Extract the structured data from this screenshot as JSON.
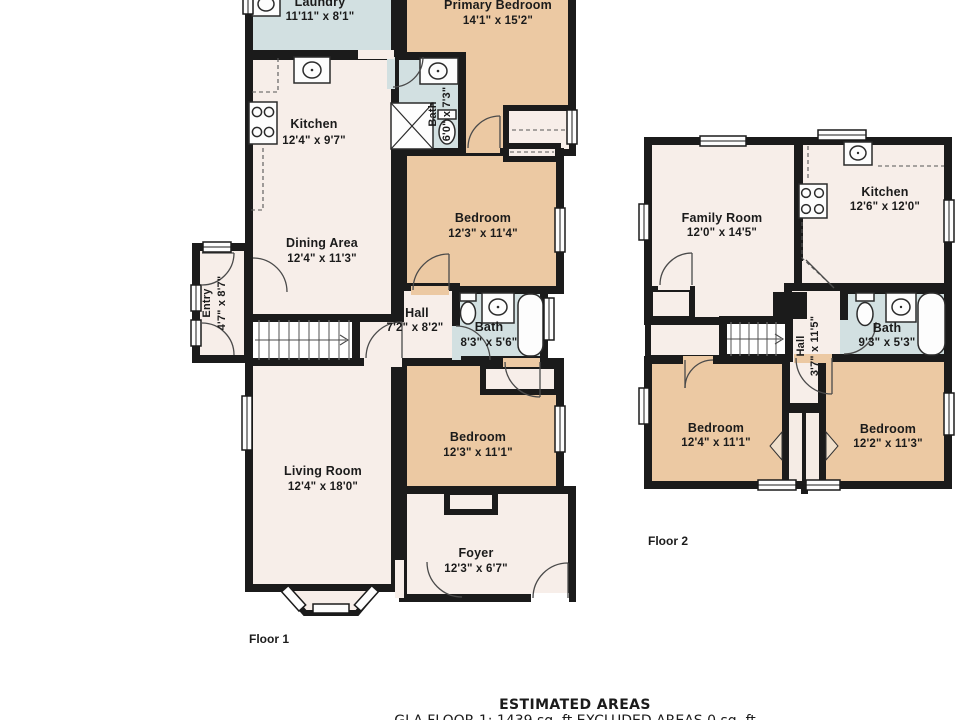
{
  "floor1": {
    "label": "Floor 1",
    "rooms": {
      "laundry": {
        "name": "Laundry",
        "dims": "11'11\" x 8'1\""
      },
      "primary": {
        "name": "Primary Bedroom",
        "dims": "14'1\" x 15'2\""
      },
      "primary_bath": {
        "name": "Bath",
        "dims": "6'0\" x 7'3\""
      },
      "kitchen": {
        "name": "Kitchen",
        "dims": "12'4\" x 9'7\""
      },
      "dining": {
        "name": "Dining Area",
        "dims": "12'4\" x 11'3\""
      },
      "bedroom2": {
        "name": "Bedroom",
        "dims": "12'3\" x 11'4\""
      },
      "hall": {
        "name": "Hall",
        "dims": "7'2\" x 8'2\""
      },
      "bath": {
        "name": "Bath",
        "dims": "8'3\" x 5'6\""
      },
      "entry": {
        "name": "Entry",
        "dims": "4'7\" x 8'7\""
      },
      "living": {
        "name": "Living Room",
        "dims": "12'4\" x 18'0\""
      },
      "bedroom3": {
        "name": "Bedroom",
        "dims": "12'3\" x 11'1\""
      },
      "foyer": {
        "name": "Foyer",
        "dims": "12'3\" x 6'7\""
      }
    }
  },
  "floor2": {
    "label": "Floor 2",
    "rooms": {
      "family": {
        "name": "Family Room",
        "dims": "12'0\" x 14'5\""
      },
      "kitchen": {
        "name": "Kitchen",
        "dims": "12'6\" x 12'0\""
      },
      "bath": {
        "name": "Bath",
        "dims": "9'3\" x 5'3\""
      },
      "hall": {
        "name": "Hall",
        "dims": "3'7\" x 11'5\""
      },
      "bedroom_left": {
        "name": "Bedroom",
        "dims": "12'4\" x 11'1\""
      },
      "bedroom_right": {
        "name": "Bedroom",
        "dims": "12'2\" x 11'3\""
      }
    }
  },
  "footer": {
    "title": "ESTIMATED AREAS",
    "line1": "GLA FLOOR 1: 1439 sq. ft EXCLUDED AREAS 0 sq. ft"
  },
  "colors": {
    "walls": "#1b1b1b",
    "room": "#f7eee9",
    "bedroom": "#ecc9a3",
    "bath": "#d2e0e1",
    "stairs": "#ffffff",
    "background": "#ffffff"
  }
}
